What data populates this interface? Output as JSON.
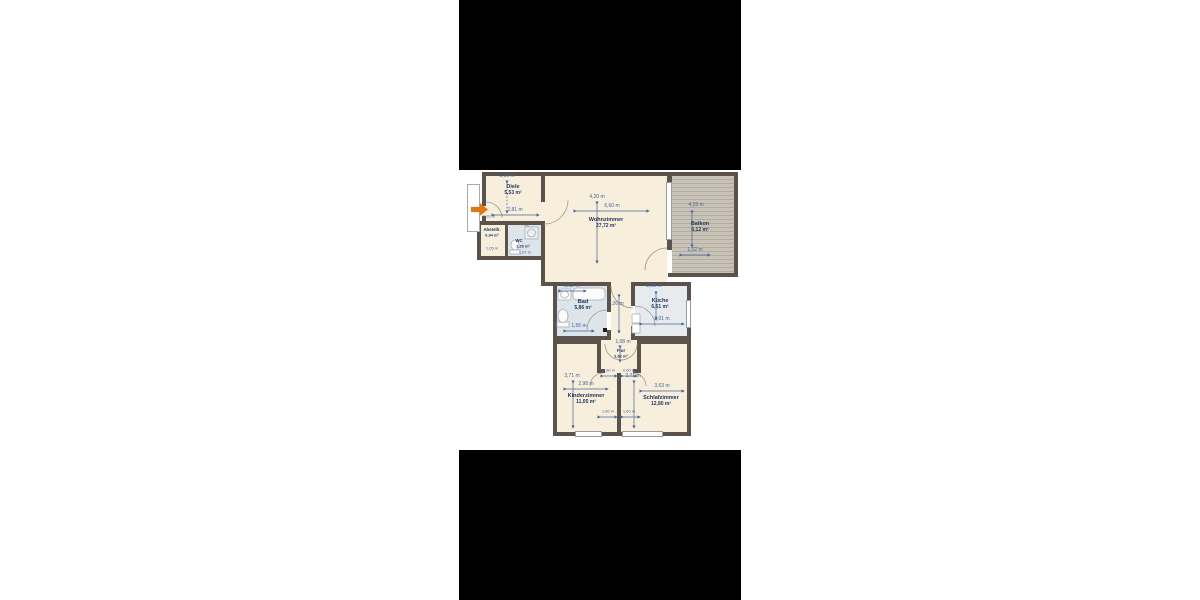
{
  "floorplan": {
    "rooms": {
      "diele": {
        "name": "Diele",
        "area": "5,53 m²"
      },
      "abstell": {
        "name": "Abstellr.",
        "area": "0,94 m²"
      },
      "wc": {
        "name": "WC",
        "area": "1,29 m²"
      },
      "wohnzimmer": {
        "name": "Wohnzimmer",
        "area": "27,72 m²"
      },
      "balkon": {
        "name": "Balkon",
        "area": "6,12 m²"
      },
      "bad": {
        "name": "Bad",
        "area": "5,86 m²"
      },
      "kueche": {
        "name": "Küche",
        "area": "6,51 m²"
      },
      "flur": {
        "name": "Flur",
        "area": "3,62 m²"
      },
      "kinderzimmer": {
        "name": "Kinderzimmer",
        "area": "11,05 m²"
      },
      "schlafzimmer": {
        "name": "Schlafzimmer",
        "area": "12,80 m²"
      }
    },
    "dims": {
      "diele_top": "1,90 m",
      "diele_width": "2,81 m",
      "abstell_top": "0,92 m",
      "abstell_bottom": "1,05 m",
      "wc_bottom": "1,07 m",
      "wohnzimmer_height": "4,20 m",
      "wohnzimmer_width": "6,60 m",
      "balkon_height": "4,19 m",
      "balkon_width": "1,02 m",
      "bad_top": "2,12 m",
      "bad_bottom": "1,56 m",
      "corridor_height": "2,26 m",
      "kueche_top": "2,15 m",
      "kueche_bottom": "3,01 m",
      "flur_height": "1,08 m",
      "flur_door_left": "0,60 m",
      "flur_door_right": "0,60 m",
      "kinderzimmer_height": "3,71 m",
      "kinderzimmer_width": "2,98 m",
      "schlafzimmer_height": "3,71 m",
      "schlafzimmer_width": "3,63 m",
      "window_left": "1,60 m",
      "window_right": "1,60 m"
    },
    "colors": {
      "wall": "#5a524b",
      "floor": "#f7efdc",
      "bath_tile": "#dde4ea",
      "kitchen_floor": "#e8ebee",
      "balcony": "#c9c2b7",
      "dimension_text": "#46659a",
      "room_text": "#22365c",
      "entrance_arrow": "#e0761c",
      "letterbox": "#000000",
      "page_background": "#ffffff"
    }
  }
}
